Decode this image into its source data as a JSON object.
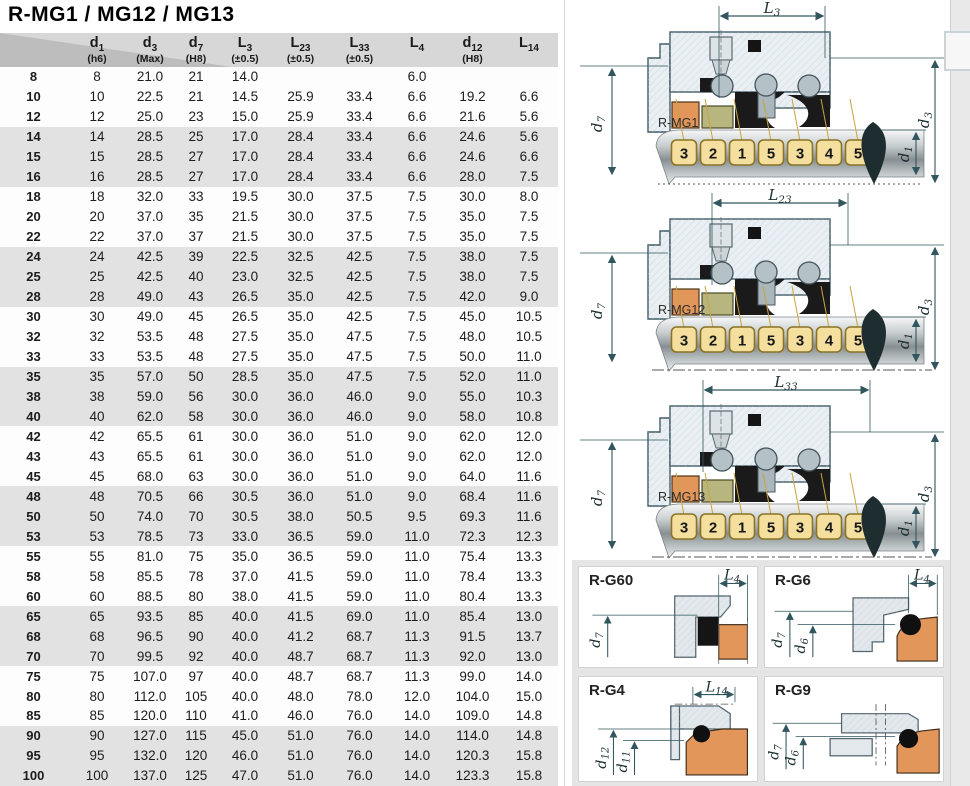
{
  "title": "R-MG1 / MG12 / MG13",
  "colors": {
    "header_gray": "#d7d7d7",
    "corner_gray": "#bdbdbd",
    "band_gray": "#e2e2e2",
    "dimension_line": "#31565e",
    "seal_orange": "#e2965a",
    "seal_olive": "#b6b67e",
    "badge_fill": "#f4df9e",
    "badge_border": "#8a7326"
  },
  "table": {
    "columns": [
      {
        "base": "d",
        "sub": "1",
        "tol": "(h6)"
      },
      {
        "base": "d",
        "sub": "3",
        "tol": "(Max)"
      },
      {
        "base": "d",
        "sub": "7",
        "tol": "(H8)"
      },
      {
        "base": "L",
        "sub": "3",
        "tol": "(±0.5)"
      },
      {
        "base": "L",
        "sub": "23",
        "tol": "(±0.5)"
      },
      {
        "base": "L",
        "sub": "33",
        "tol": "(±0.5)"
      },
      {
        "base": "L",
        "sub": "4",
        "tol": ""
      },
      {
        "base": "d",
        "sub": "12",
        "tol": "(H8)"
      },
      {
        "base": "L",
        "sub": "14",
        "tol": ""
      }
    ],
    "rows": [
      {
        "size": "8",
        "d1": "8",
        "d3": "21.0",
        "d7": "21",
        "L3": "14.0",
        "L23": "",
        "L33": "",
        "L4": "6.0",
        "d12": "",
        "L14": ""
      },
      {
        "size": "10",
        "d1": "10",
        "d3": "22.5",
        "d7": "21",
        "L3": "14.5",
        "L23": "25.9",
        "L33": "33.4",
        "L4": "6.6",
        "d12": "19.2",
        "L14": "6.6"
      },
      {
        "size": "12",
        "d1": "12",
        "d3": "25.0",
        "d7": "23",
        "L3": "15.0",
        "L23": "25.9",
        "L33": "33.4",
        "L4": "6.6",
        "d12": "21.6",
        "L14": "5.6"
      },
      {
        "size": "14",
        "d1": "14",
        "d3": "28.5",
        "d7": "25",
        "L3": "17.0",
        "L23": "28.4",
        "L33": "33.4",
        "L4": "6.6",
        "d12": "24.6",
        "L14": "5.6"
      },
      {
        "size": "15",
        "d1": "15",
        "d3": "28.5",
        "d7": "27",
        "L3": "17.0",
        "L23": "28.4",
        "L33": "33.4",
        "L4": "6.6",
        "d12": "24.6",
        "L14": "6.6"
      },
      {
        "size": "16",
        "d1": "16",
        "d3": "28.5",
        "d7": "27",
        "L3": "17.0",
        "L23": "28.4",
        "L33": "33.4",
        "L4": "6.6",
        "d12": "28.0",
        "L14": "7.5"
      },
      {
        "size": "18",
        "d1": "18",
        "d3": "32.0",
        "d7": "33",
        "L3": "19.5",
        "L23": "30.0",
        "L33": "37.5",
        "L4": "7.5",
        "d12": "30.0",
        "L14": "8.0"
      },
      {
        "size": "20",
        "d1": "20",
        "d3": "37.0",
        "d7": "35",
        "L3": "21.5",
        "L23": "30.0",
        "L33": "37.5",
        "L4": "7.5",
        "d12": "35.0",
        "L14": "7.5"
      },
      {
        "size": "22",
        "d1": "22",
        "d3": "37.0",
        "d7": "37",
        "L3": "21.5",
        "L23": "30.0",
        "L33": "37.5",
        "L4": "7.5",
        "d12": "35.0",
        "L14": "7.5"
      },
      {
        "size": "24",
        "d1": "24",
        "d3": "42.5",
        "d7": "39",
        "L3": "22.5",
        "L23": "32.5",
        "L33": "42.5",
        "L4": "7.5",
        "d12": "38.0",
        "L14": "7.5"
      },
      {
        "size": "25",
        "d1": "25",
        "d3": "42.5",
        "d7": "40",
        "L3": "23.0",
        "L23": "32.5",
        "L33": "42.5",
        "L4": "7.5",
        "d12": "38.0",
        "L14": "7.5"
      },
      {
        "size": "28",
        "d1": "28",
        "d3": "49.0",
        "d7": "43",
        "L3": "26.5",
        "L23": "35.0",
        "L33": "42.5",
        "L4": "7.5",
        "d12": "42.0",
        "L14": "9.0"
      },
      {
        "size": "30",
        "d1": "30",
        "d3": "49.0",
        "d7": "45",
        "L3": "26.5",
        "L23": "35.0",
        "L33": "42.5",
        "L4": "7.5",
        "d12": "45.0",
        "L14": "10.5"
      },
      {
        "size": "32",
        "d1": "32",
        "d3": "53.5",
        "d7": "48",
        "L3": "27.5",
        "L23": "35.0",
        "L33": "47.5",
        "L4": "7.5",
        "d12": "48.0",
        "L14": "10.5"
      },
      {
        "size": "33",
        "d1": "33",
        "d3": "53.5",
        "d7": "48",
        "L3": "27.5",
        "L23": "35.0",
        "L33": "47.5",
        "L4": "7.5",
        "d12": "50.0",
        "L14": "11.0"
      },
      {
        "size": "35",
        "d1": "35",
        "d3": "57.0",
        "d7": "50",
        "L3": "28.5",
        "L23": "35.0",
        "L33": "47.5",
        "L4": "7.5",
        "d12": "52.0",
        "L14": "11.0"
      },
      {
        "size": "38",
        "d1": "38",
        "d3": "59.0",
        "d7": "56",
        "L3": "30.0",
        "L23": "36.0",
        "L33": "46.0",
        "L4": "9.0",
        "d12": "55.0",
        "L14": "10.3"
      },
      {
        "size": "40",
        "d1": "40",
        "d3": "62.0",
        "d7": "58",
        "L3": "30.0",
        "L23": "36.0",
        "L33": "46.0",
        "L4": "9.0",
        "d12": "58.0",
        "L14": "10.8"
      },
      {
        "size": "42",
        "d1": "42",
        "d3": "65.5",
        "d7": "61",
        "L3": "30.0",
        "L23": "36.0",
        "L33": "51.0",
        "L4": "9.0",
        "d12": "62.0",
        "L14": "12.0"
      },
      {
        "size": "43",
        "d1": "43",
        "d3": "65.5",
        "d7": "61",
        "L3": "30.0",
        "L23": "36.0",
        "L33": "51.0",
        "L4": "9.0",
        "d12": "62.0",
        "L14": "12.0"
      },
      {
        "size": "45",
        "d1": "45",
        "d3": "68.0",
        "d7": "63",
        "L3": "30.0",
        "L23": "36.0",
        "L33": "51.0",
        "L4": "9.0",
        "d12": "64.0",
        "L14": "11.6"
      },
      {
        "size": "48",
        "d1": "48",
        "d3": "70.5",
        "d7": "66",
        "L3": "30.5",
        "L23": "36.0",
        "L33": "51.0",
        "L4": "9.0",
        "d12": "68.4",
        "L14": "11.6"
      },
      {
        "size": "50",
        "d1": "50",
        "d3": "74.0",
        "d7": "70",
        "L3": "30.5",
        "L23": "38.0",
        "L33": "50.5",
        "L4": "9.5",
        "d12": "69.3",
        "L14": "11.6"
      },
      {
        "size": "53",
        "d1": "53",
        "d3": "78.5",
        "d7": "73",
        "L3": "33.0",
        "L23": "36.5",
        "L33": "59.0",
        "L4": "11.0",
        "d12": "72.3",
        "L14": "12.3"
      },
      {
        "size": "55",
        "d1": "55",
        "d3": "81.0",
        "d7": "75",
        "L3": "35.0",
        "L23": "36.5",
        "L33": "59.0",
        "L4": "11.0",
        "d12": "75.4",
        "L14": "13.3"
      },
      {
        "size": "58",
        "d1": "58",
        "d3": "85.5",
        "d7": "78",
        "L3": "37.0",
        "L23": "41.5",
        "L33": "59.0",
        "L4": "11.0",
        "d12": "78.4",
        "L14": "13.3"
      },
      {
        "size": "60",
        "d1": "60",
        "d3": "88.5",
        "d7": "80",
        "L3": "38.0",
        "L23": "41.5",
        "L33": "59.0",
        "L4": "11.0",
        "d12": "80.4",
        "L14": "13.3"
      },
      {
        "size": "65",
        "d1": "65",
        "d3": "93.5",
        "d7": "85",
        "L3": "40.0",
        "L23": "41.5",
        "L33": "69.0",
        "L4": "11.0",
        "d12": "85.4",
        "L14": "13.0"
      },
      {
        "size": "68",
        "d1": "68",
        "d3": "96.5",
        "d7": "90",
        "L3": "40.0",
        "L23": "41.2",
        "L33": "68.7",
        "L4": "11.3",
        "d12": "91.5",
        "L14": "13.7"
      },
      {
        "size": "70",
        "d1": "70",
        "d3": "99.5",
        "d7": "92",
        "L3": "40.0",
        "L23": "48.7",
        "L33": "68.7",
        "L4": "11.3",
        "d12": "92.0",
        "L14": "13.0"
      },
      {
        "size": "75",
        "d1": "75",
        "d3": "107.0",
        "d7": "97",
        "L3": "40.0",
        "L23": "48.7",
        "L33": "68.7",
        "L4": "11.3",
        "d12": "99.0",
        "L14": "14.0"
      },
      {
        "size": "80",
        "d1": "80",
        "d3": "112.0",
        "d7": "105",
        "L3": "40.0",
        "L23": "48.0",
        "L33": "78.0",
        "L4": "12.0",
        "d12": "104.0",
        "L14": "15.0"
      },
      {
        "size": "85",
        "d1": "85",
        "d3": "120.0",
        "d7": "110",
        "L3": "41.0",
        "L23": "46.0",
        "L33": "76.0",
        "L4": "14.0",
        "d12": "109.0",
        "L14": "14.8"
      },
      {
        "size": "90",
        "d1": "90",
        "d3": "127.0",
        "d7": "115",
        "L3": "45.0",
        "L23": "51.0",
        "L33": "76.0",
        "L4": "14.0",
        "d12": "114.0",
        "L14": "14.8"
      },
      {
        "size": "95",
        "d1": "95",
        "d3": "132.0",
        "d7": "120",
        "L3": "46.0",
        "L23": "51.0",
        "L33": "76.0",
        "L4": "14.0",
        "d12": "120.3",
        "L14": "15.8"
      },
      {
        "size": "100",
        "d1": "100",
        "d3": "137.0",
        "d7": "125",
        "L3": "47.0",
        "L23": "51.0",
        "L33": "76.0",
        "L4": "14.0",
        "d12": "123.3",
        "L14": "15.8"
      }
    ]
  },
  "diagrams": {
    "badge_sequence": [
      "3",
      "2",
      "1",
      "5",
      "3",
      "4",
      "5"
    ],
    "mg1": {
      "name": "R-MG1",
      "dim": {
        "base": "L",
        "sub": "3"
      },
      "left": {
        "base": "d",
        "sub": "7"
      },
      "right1": {
        "base": "d",
        "sub": "1"
      },
      "right2": {
        "base": "d",
        "sub": "3"
      }
    },
    "mg12": {
      "name": "R-MG12",
      "dim": {
        "base": "L",
        "sub": "23"
      },
      "left": {
        "base": "d",
        "sub": "7"
      },
      "right1": {
        "base": "d",
        "sub": "1"
      },
      "right2": {
        "base": "d",
        "sub": "3"
      }
    },
    "mg13": {
      "name": "R-MG13",
      "dim": {
        "base": "L",
        "sub": "33"
      },
      "left": {
        "base": "d",
        "sub": "7"
      },
      "right1": {
        "base": "d",
        "sub": "1"
      },
      "right2": {
        "base": "d",
        "sub": "3"
      }
    }
  },
  "panels": {
    "g60": {
      "name": "R-G60",
      "dim": {
        "base": "L",
        "sub": "4"
      },
      "dims_left": [
        {
          "base": "d",
          "sub": "7"
        }
      ]
    },
    "g6": {
      "name": "R-G6",
      "dim": {
        "base": "L",
        "sub": "4"
      },
      "dims_left": [
        {
          "base": "d",
          "sub": "7"
        },
        {
          "base": "d",
          "sub": "6"
        }
      ]
    },
    "g4": {
      "name": "R-G4",
      "dim": {
        "base": "L",
        "sub": "14"
      },
      "dims_left": [
        {
          "base": "d",
          "sub": "12"
        },
        {
          "base": "d",
          "sub": "11"
        }
      ]
    },
    "g9": {
      "name": "R-G9",
      "dims_left": [
        {
          "base": "d",
          "sub": "7"
        },
        {
          "base": "d",
          "sub": "6"
        }
      ]
    }
  }
}
